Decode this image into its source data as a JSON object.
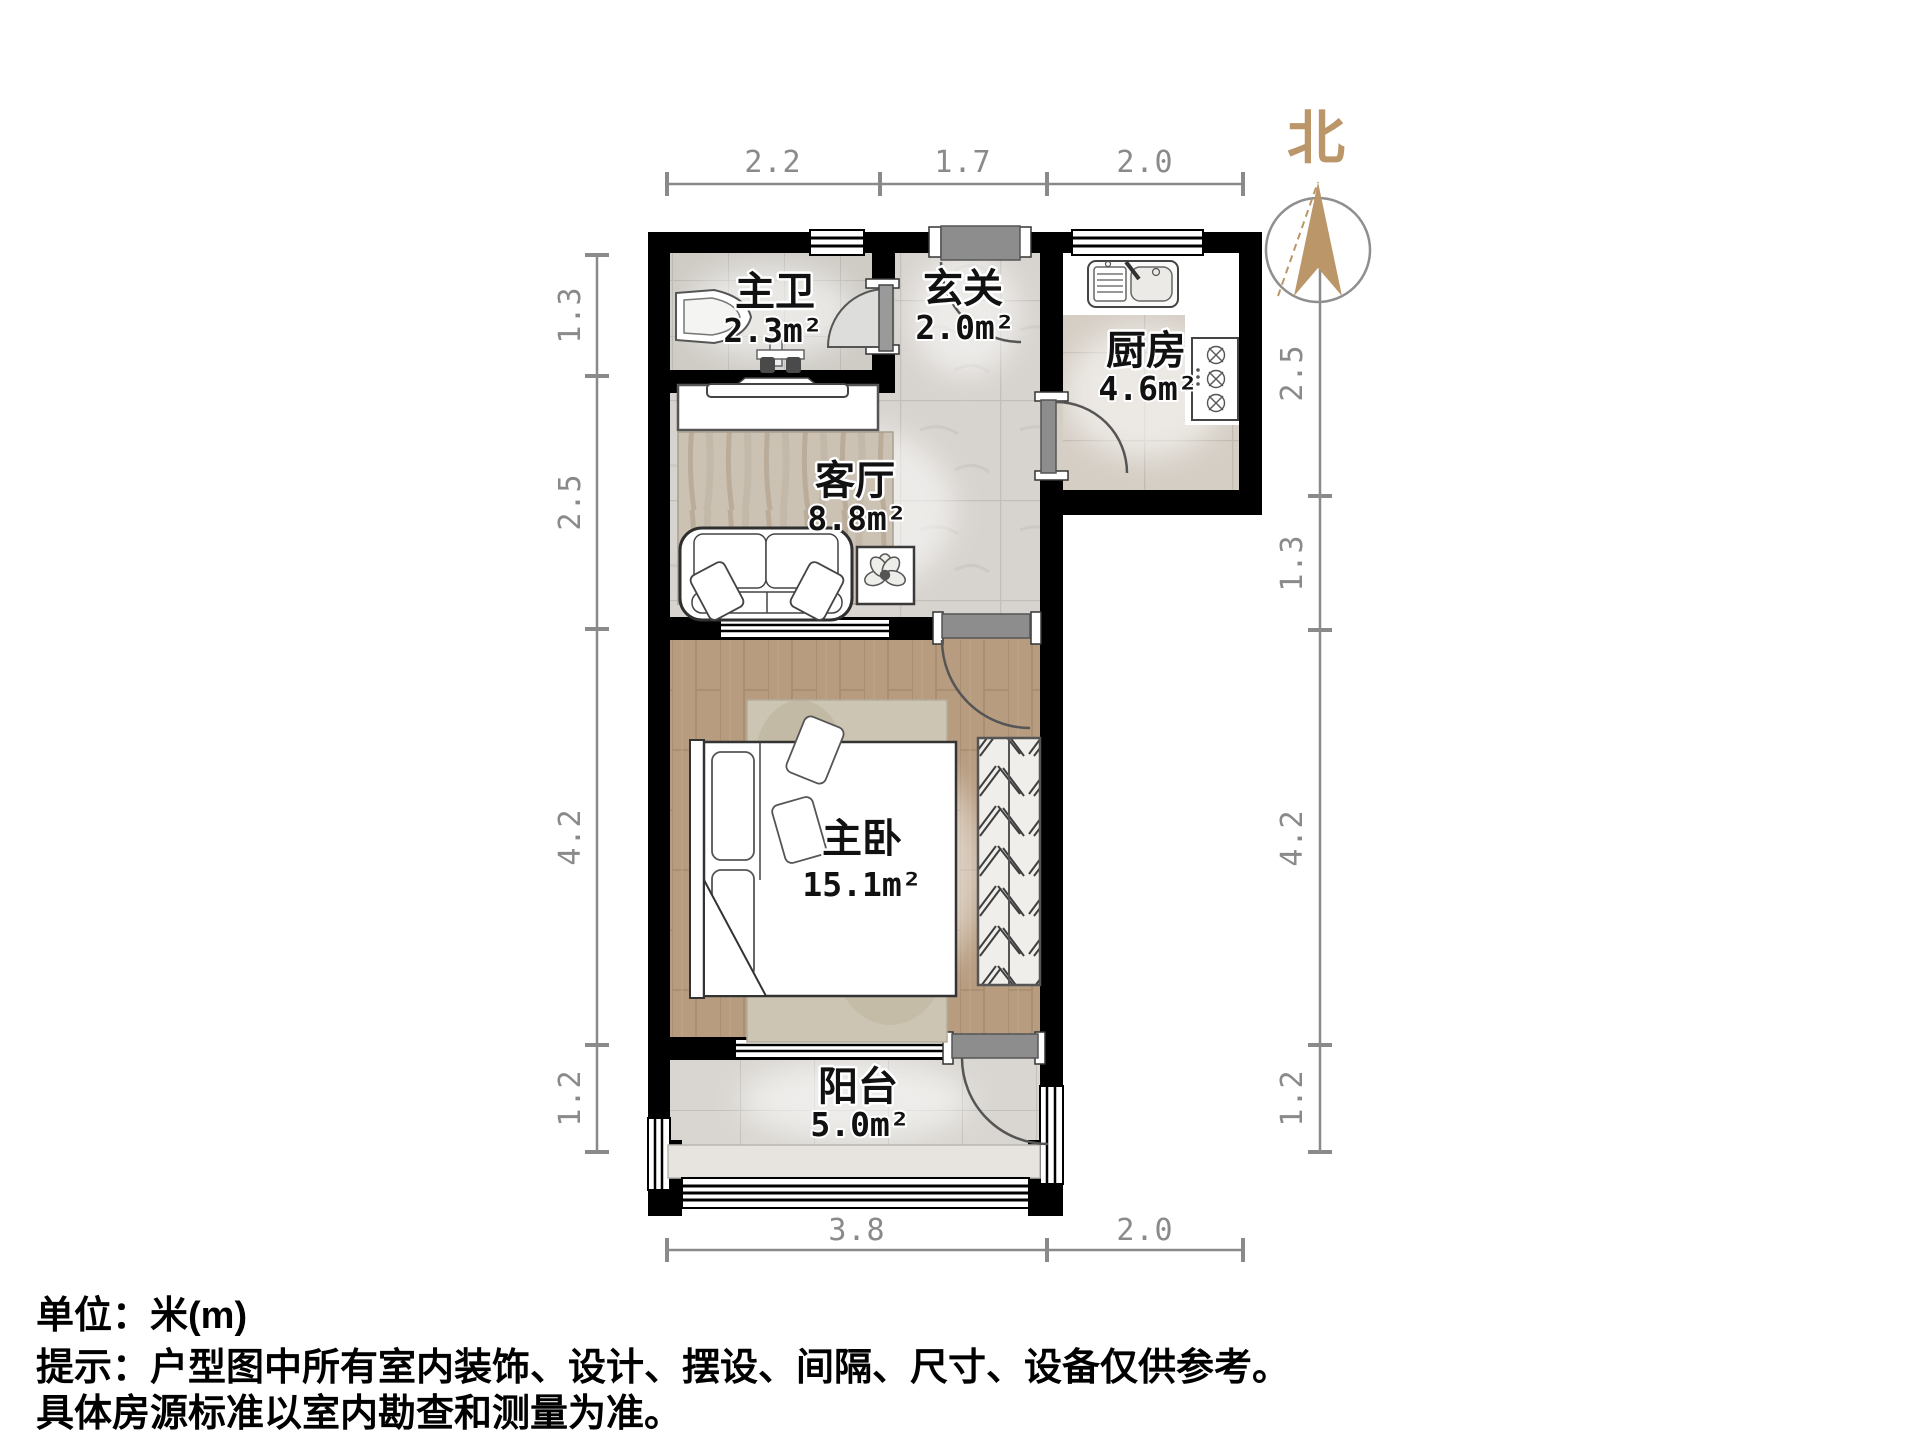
{
  "title": "户型图 (floor plan)",
  "north": {
    "label": "北"
  },
  "rooms": {
    "bathroom": {
      "name": "主卫",
      "area": "2.3m²"
    },
    "entry": {
      "name": "玄关",
      "area": "2.0m²"
    },
    "kitchen": {
      "name": "厨房",
      "area": "4.6m²"
    },
    "living": {
      "name": "客厅",
      "area": "8.8m²"
    },
    "bedroom": {
      "name": "主卧",
      "area": "15.1m²"
    },
    "balcony": {
      "name": "阳台",
      "area": "5.0m²"
    }
  },
  "dimensions": {
    "unit": "米",
    "top": [
      "2.2",
      "1.7",
      "2.0"
    ],
    "left": [
      "1.3",
      "2.5",
      "4.2",
      "1.2"
    ],
    "right": [
      "2.5",
      "1.3",
      "4.2",
      "1.2"
    ],
    "bottom": [
      "3.8",
      "2.0"
    ]
  },
  "footer": {
    "unit_line": "单位：米(m)",
    "hint_line1": "提示：户型图中所有室内装饰、设计、摆设、间隔、尺寸、设备仅供参考。",
    "hint_line2": "具体房源标准以室内勘查和测量为准。"
  },
  "colors": {
    "wall": "#000000",
    "dimension": "#8a8a8a",
    "north_accent": "#bb9668",
    "wood_floor": "#b79c80",
    "tile_floor": "#d9d5d0",
    "door_leaf": "#8d8d8d"
  }
}
